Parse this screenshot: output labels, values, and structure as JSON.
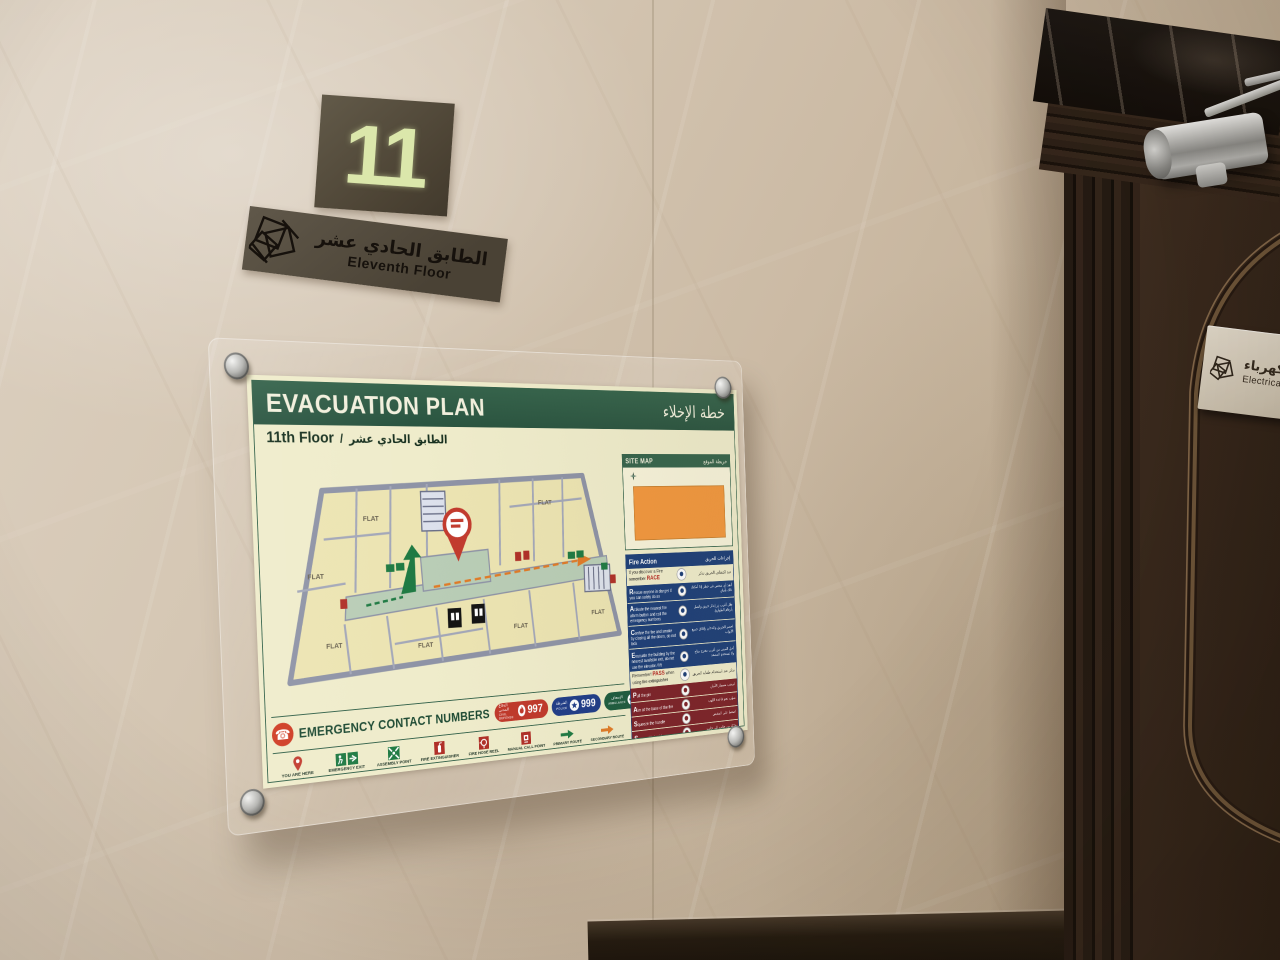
{
  "floor_sign": {
    "number": "11",
    "name_ar": "الطابق الحادي عشر",
    "name_en": "Eleventh Floor"
  },
  "door_sign": {
    "name_ar": "غرفة الكهرباء",
    "name_en": "Electrical Room"
  },
  "poster": {
    "title_en": "EVACUATION PLAN",
    "title_ar": "خطة الإخلاء",
    "floor_en": "11th Floor",
    "separator": "/",
    "floor_ar": "الطابق الحادي عشر",
    "site_map": {
      "title_en": "SITE MAP",
      "title_ar": "خريطة الموقع"
    },
    "fire_action": {
      "title_en": "Fire Action",
      "title_ar": "إجراءات الحريق",
      "race_intro_en": "If you discover a Fire remember ",
      "race_word": "RACE",
      "race_intro_ar": "عند اكتشاف الحريق تذكر",
      "race": [
        {
          "en": "Rescue anyone in danger if you can safely do so",
          "ar": "أنقذ أي شخص في خطر إذا أمكنك ذلك بأمان"
        },
        {
          "en": "Activate the nearest fire alarm button and call the emergency numbers",
          "ar": "فعّل أقرب زر إنذار حريق واتصل بأرقام الطوارئ"
        },
        {
          "en": "Confine the fire and smoke by closing all the doors, do not lock",
          "ar": "احصر الحريق والدخان بإغلاق جميع الأبواب"
        },
        {
          "en": "Evacuate the building by the nearest available exit, do not use the elevator / lift",
          "ar": "أخلِ المبنى من أقرب مخرج متاح ولا تستخدم المصعد"
        }
      ],
      "pass_intro_en": "Remember! ",
      "pass_word": "PASS",
      "pass_intro_tail": " when using fire extinguisher",
      "pass_intro_ar": "تذكر عند استخدام طفاية الحريق",
      "pass": [
        {
          "en": "Pull the pin",
          "ar": "اسحب مسمار الأمان"
        },
        {
          "en": "Aim at the base of the fire",
          "ar": "صوّب نحو قاعدة اللهب"
        },
        {
          "en": "Squeeze the handle",
          "ar": "اضغط على المقبض"
        },
        {
          "en": "Sweep side to side",
          "ar": "حرّك من جانب إلى جانب"
        }
      ]
    },
    "building_line1": "HAMEED MUBARAK RAGAS",
    "building_line2": "AL MANSOURI BUILDING NO. (1699)",
    "symbols": {
      "title_en": "SYMBOLS",
      "title_ar": "رموز",
      "items": [
        {
          "en": "ESCAPE ROUTE",
          "ar": "مسار الهروب"
        },
        {
          "en": "LIFT",
          "ar": "مصعد"
        },
        {
          "en": "STAIRCASE",
          "ar": "درج"
        }
      ]
    },
    "emergency": {
      "title": "EMERGENCY CONTACT NUMBERS",
      "numbers": [
        {
          "en": "CIVIL DEFENSE",
          "ar": "الدفاع المدني",
          "num": "997"
        },
        {
          "en": "POLICE",
          "ar": "الشرطة",
          "num": "999"
        },
        {
          "en": "AMBULANCE",
          "ar": "الإسعاف",
          "num": "998"
        }
      ]
    },
    "legend": [
      {
        "en": "YOU ARE HERE",
        "ar": "أنت هنا"
      },
      {
        "en": "EMERGENCY EXIT",
        "ar": "مخرج طوارئ"
      },
      {
        "en": "ASSEMBLY POINT",
        "ar": "نقطة التجمع"
      },
      {
        "en": "FIRE EXTINGUISHER",
        "ar": "طفاية حريق"
      },
      {
        "en": "FIRE HOSE REEL",
        "ar": "بكرة خرطوم الحريق"
      },
      {
        "en": "MANUAL CALL POINT",
        "ar": "نقطة الإنذار اليدوي"
      },
      {
        "en": "PRIMARY ROUTE",
        "ar": "مسار الخروج الرئيسي"
      },
      {
        "en": "SECONDARY ROUTE",
        "ar": "مسار الخروج الثانوي"
      }
    ],
    "plan": {
      "flat": "FLAT"
    }
  },
  "colors": {
    "poster_green": "#35634b",
    "fire_navy": "#1c3e78",
    "pass_maroon": "#7c2128",
    "site_map_orange": "#f2973e",
    "alert_red": "#c0392b",
    "glow_green": "#dbe7ab"
  }
}
